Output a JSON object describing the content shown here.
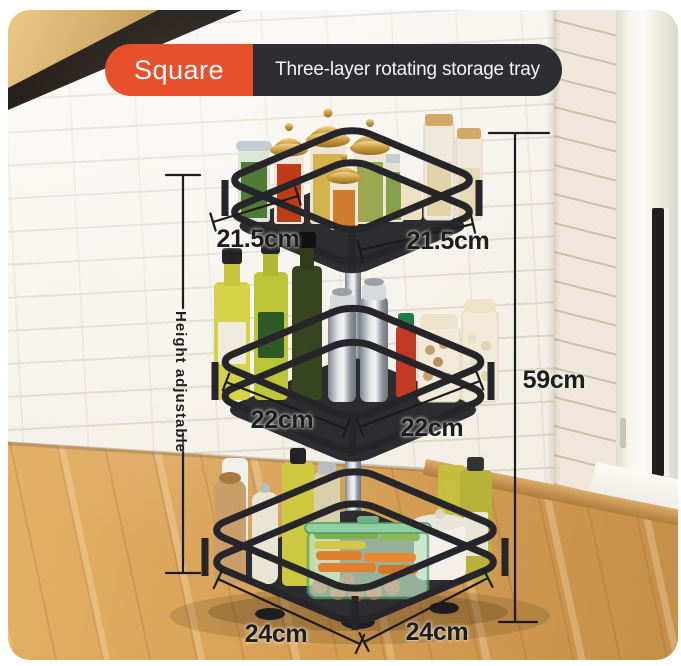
{
  "badge": {
    "shape_label": "Square",
    "title": "Three-layer rotating storage tray"
  },
  "annotations": {
    "tier1_left": "21.5cm",
    "tier1_right": "21.5cm",
    "tier2_left": "22cm",
    "tier2_right": "22cm",
    "tier3_left": "24cm",
    "tier3_right": "24cm",
    "total_height": "59cm",
    "height_note": "Height adjustable"
  },
  "colors": {
    "badge_orange": "#E8502C",
    "badge_dark": "#2E2E31",
    "annotation_text": "#1D1D1D",
    "rack_black": "#26262A"
  }
}
